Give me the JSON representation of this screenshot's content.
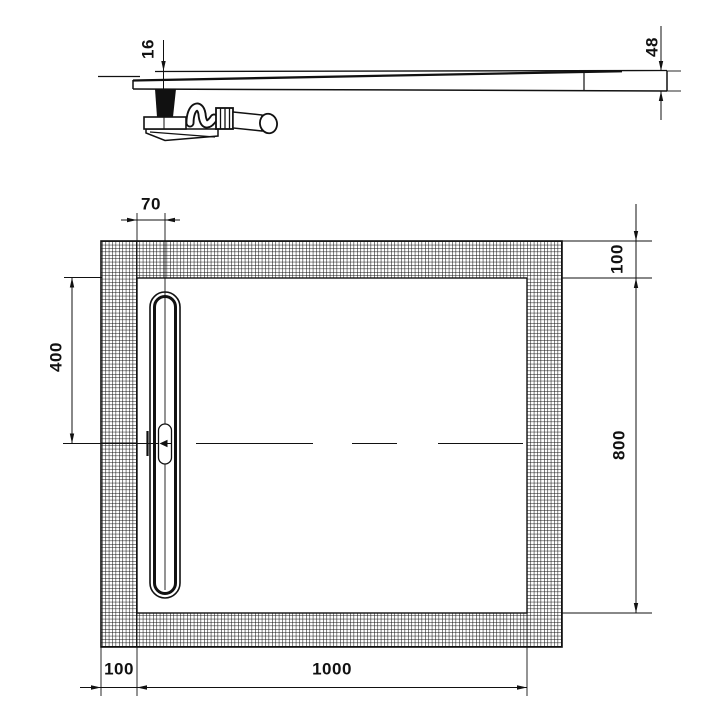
{
  "page": {
    "background": "#ffffff",
    "line_color": "#111111"
  },
  "drawing": {
    "kind": "technical dimension drawing",
    "views": {
      "side_section": "tapered tray profile with bottle trap drain",
      "plan": "rectangular tray with hatched border and linear drain channel"
    }
  },
  "labels": {
    "dim_16": "16",
    "dim_48": "48",
    "dim_70": "70",
    "dim_100_top_right": "100",
    "dim_800": "800",
    "dim_400": "400",
    "dim_100_bottom_left": "100",
    "dim_1000": "1000"
  }
}
